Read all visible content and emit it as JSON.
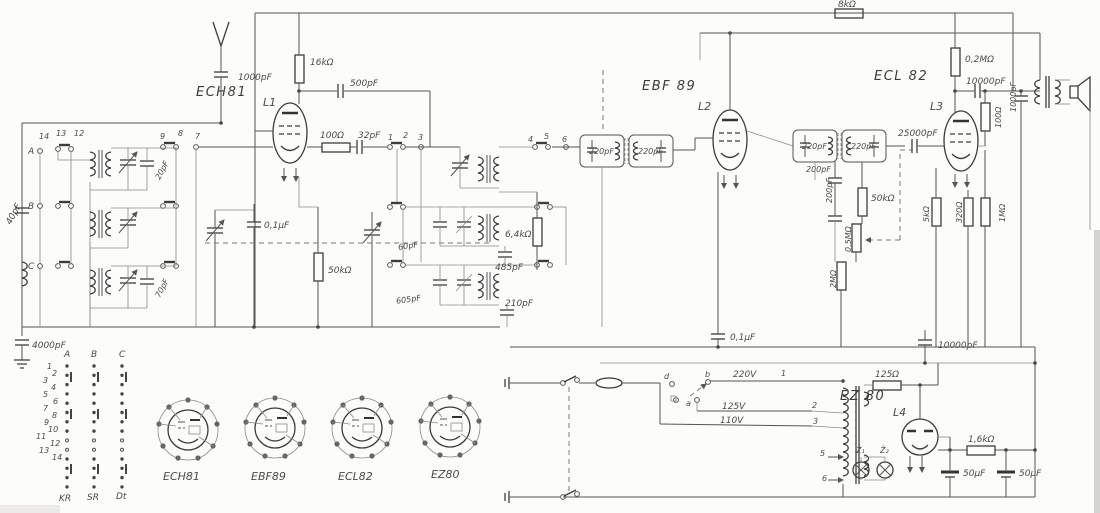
{
  "colors": {
    "ink": "#4a4a4a",
    "paper": "#fcfcfa"
  },
  "tubes": {
    "ech81": "ECH81",
    "ebf89": "EBF 89",
    "ecl82": "ECL 82",
    "ez80": "EZ 80"
  },
  "coils": {
    "l1": "L1",
    "l2": "L2",
    "l3": "L3",
    "l4": "L4"
  },
  "labels": {
    "ant_c": "1000pF",
    "in_c": "40pF",
    "gnd_c": "4000pF",
    "trim_a": "20pF",
    "trim_c": "70pF",
    "r16k": "16kΩ",
    "c500": "500pF",
    "r100": "100Ω",
    "c32": "32pF",
    "c01": "0,1μF",
    "r50k": "50kΩ",
    "c60": "60pF",
    "c605": "605pF",
    "r64": "6,4kΩ",
    "c485": "485pF",
    "c210": "210pF",
    "if1c1": "220pF",
    "if1c2": "220pF",
    "if2c1": "220pF",
    "if2c2": "220pF",
    "c200a": "200pF",
    "c200b": "200pF",
    "r50k2": "50kΩ",
    "r05m": "0,5MΩ",
    "r2m": "2MΩ",
    "c25000": "25000pF",
    "r02m": "0,2MΩ",
    "c10000": "10000pF",
    "r100b": "100Ω",
    "c1000": "1000pF",
    "r8k": "8kΩ",
    "r5k": "5kΩ",
    "r320": "320Ω",
    "r1m": "1MΩ",
    "c01b": "0,1μF",
    "c10000b": "10000pF",
    "r125": "125Ω",
    "r16": "1,6kΩ",
    "c50a": "50μF",
    "c50b": "50μF"
  },
  "pins": {
    "a": "A",
    "b": "B",
    "c": "C",
    "p14": "14",
    "p13": "13",
    "p12": "12",
    "p9": "9",
    "p8": "8",
    "p7": "7",
    "p1": "1",
    "p2": "2",
    "p3": "3",
    "p4": "4",
    "p5": "5",
    "p6": "6"
  },
  "power": {
    "v220": "220V",
    "v125": "125V",
    "v110": "110V",
    "t1": "1",
    "t2": "2",
    "t3": "3",
    "ka": "a",
    "kb": "b",
    "kd": "d",
    "s5": "5",
    "s6": "6",
    "z1": "Ž₁",
    "z2": "Ž₂"
  },
  "table": {
    "cols": [
      "A",
      "B",
      "C"
    ],
    "rows": [
      "1",
      "2",
      "3",
      "4",
      "5",
      "6",
      "7",
      "8",
      "9",
      "10",
      "11",
      "12",
      "13",
      "14"
    ],
    "bands": [
      "KR",
      "SR",
      "Dt"
    ]
  },
  "bases": [
    "ECH81",
    "EBF89",
    "ECL82",
    "EZ80"
  ]
}
